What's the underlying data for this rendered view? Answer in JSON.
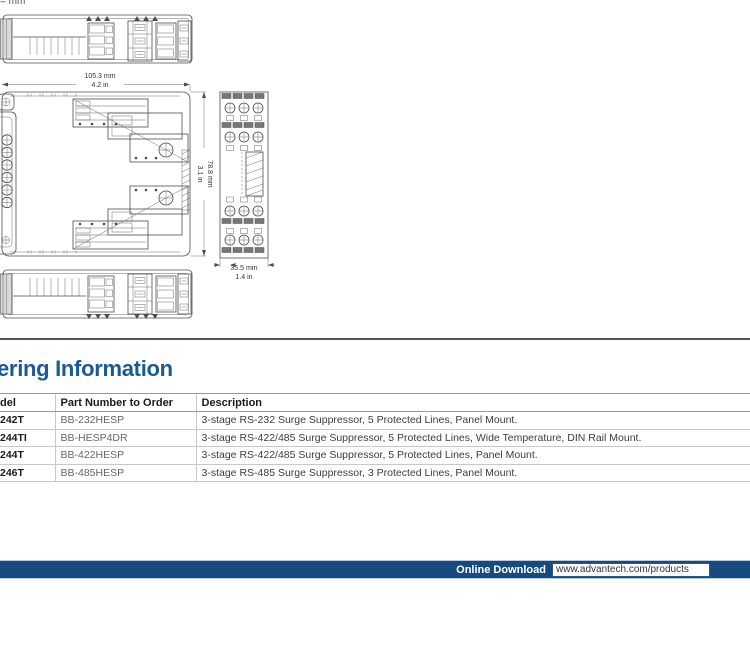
{
  "page": {
    "unit_note": "= mm"
  },
  "drawings": {
    "dims": {
      "width_mm": "105.3 mm",
      "width_in": "4.2 in",
      "height_mm": "78.8 mm",
      "height_in": "3.1 in",
      "depth_mm": "35.5 mm",
      "depth_in": "1.4 in"
    }
  },
  "ordering": {
    "heading": "ering Information",
    "table": {
      "headers": {
        "model": "del",
        "part": "Part Number to Order",
        "desc": "Description"
      },
      "rows": [
        {
          "model": "242T",
          "part": "BB-232HESP",
          "desc": "3-stage RS-232 Surge Suppressor, 5 Protected Lines, Panel Mount."
        },
        {
          "model": "244TI",
          "part": "BB-HESP4DR",
          "desc": "3-stage RS-422/485 Surge Suppressor, 5 Protected Lines, Wide Temperature, DIN Rail Mount."
        },
        {
          "model": "244T",
          "part": "BB-422HESP",
          "desc": "3-stage RS-422/485 Surge Suppressor, 5 Protected Lines, Panel Mount."
        },
        {
          "model": "246T",
          "part": "BB-485HESP",
          "desc": "3-stage RS-485 Surge Suppressor, 3 Protected Lines, Panel Mount."
        }
      ]
    }
  },
  "footer": {
    "label": "Online Download",
    "url": "www.advantech.com/products"
  },
  "colors": {
    "heading_blue": "#1a5a96",
    "footer_navy": "#174a7e",
    "drawing_stroke": "#4d4d4d",
    "divider_gray": "#555555"
  }
}
